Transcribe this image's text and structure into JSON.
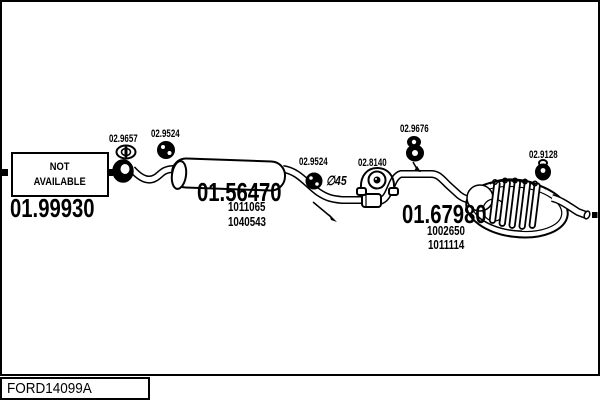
{
  "frame": {
    "code": "FORD14099A"
  },
  "colors": {
    "ink": "#000000",
    "paper": "#ffffff"
  },
  "front_section": {
    "availability_line1": "NOT",
    "availability_line2": "AVAILABLE",
    "part_number": "01.99930",
    "clamp_label": "02.9657",
    "mount_label": "02.9524"
  },
  "middle_section": {
    "part_number": "01.56470",
    "ref_numbers": [
      "1011065",
      "1040543"
    ],
    "mount_label": "02.9524",
    "pipe_diameter": "∅45",
    "clamp_label": "02.8140"
  },
  "rear_section": {
    "part_number": "01.67980",
    "ref_numbers": [
      "1002650",
      "1011114"
    ],
    "hanger_label": "02.9676",
    "tail_hanger_label": "02.9128"
  }
}
